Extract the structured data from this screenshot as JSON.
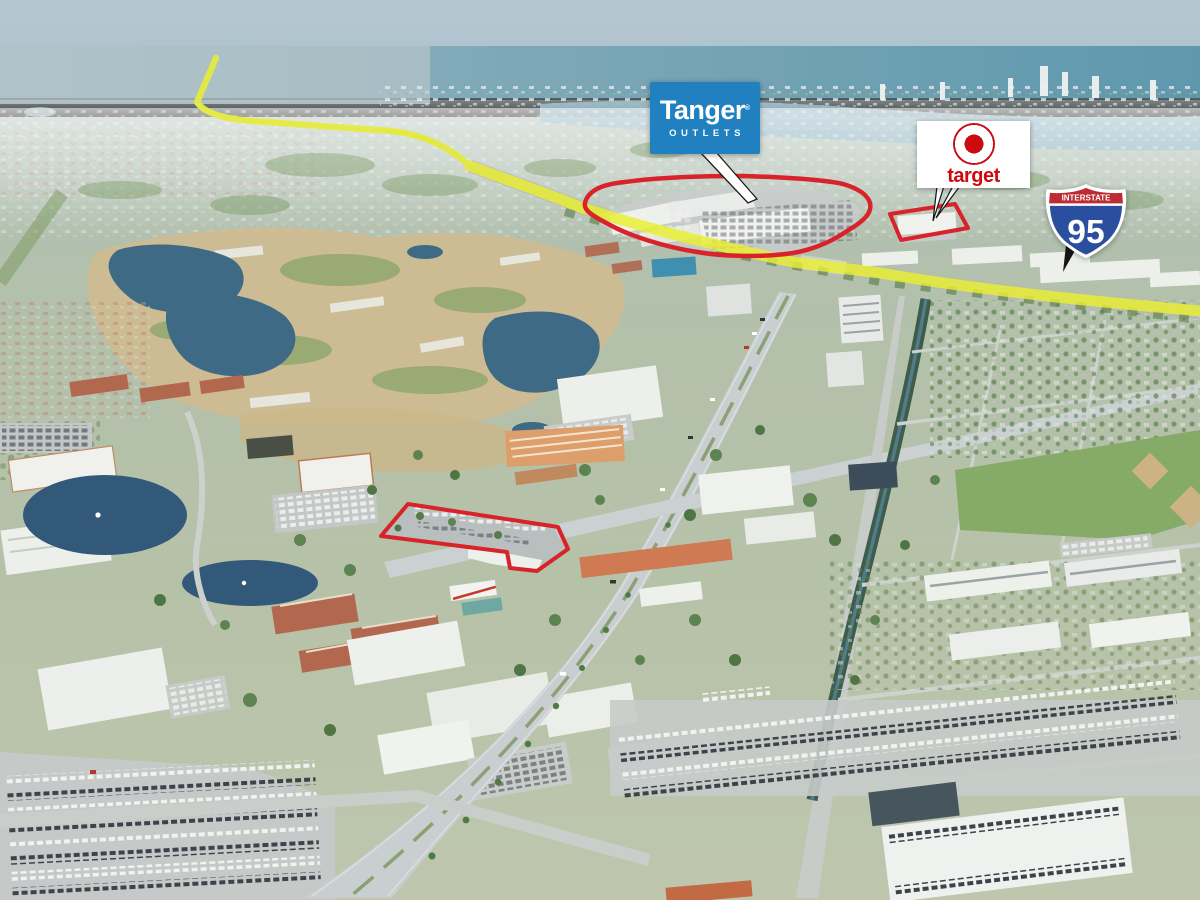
{
  "annotations": {
    "tanger_logo": {
      "brand": "Tanger",
      "registered_mark": "®",
      "subtitle": "OUTLETS",
      "bg_color": "#2080c0",
      "text_color": "#ffffff"
    },
    "target_logo": {
      "brand": "target",
      "brand_color": "#cc0a0f",
      "bg_color": "#ffffff"
    },
    "interstate_shield": {
      "top_label": "INTERSTATE",
      "route_number": "95",
      "band_color": "#bf2b33",
      "body_color": "#2a4f9f",
      "border_color": "#ffffff"
    },
    "highlights": {
      "route_highlight_color": "#e9ef2f",
      "parcel_outline_color": "#d8232a",
      "outlined_parcels": 3
    }
  }
}
